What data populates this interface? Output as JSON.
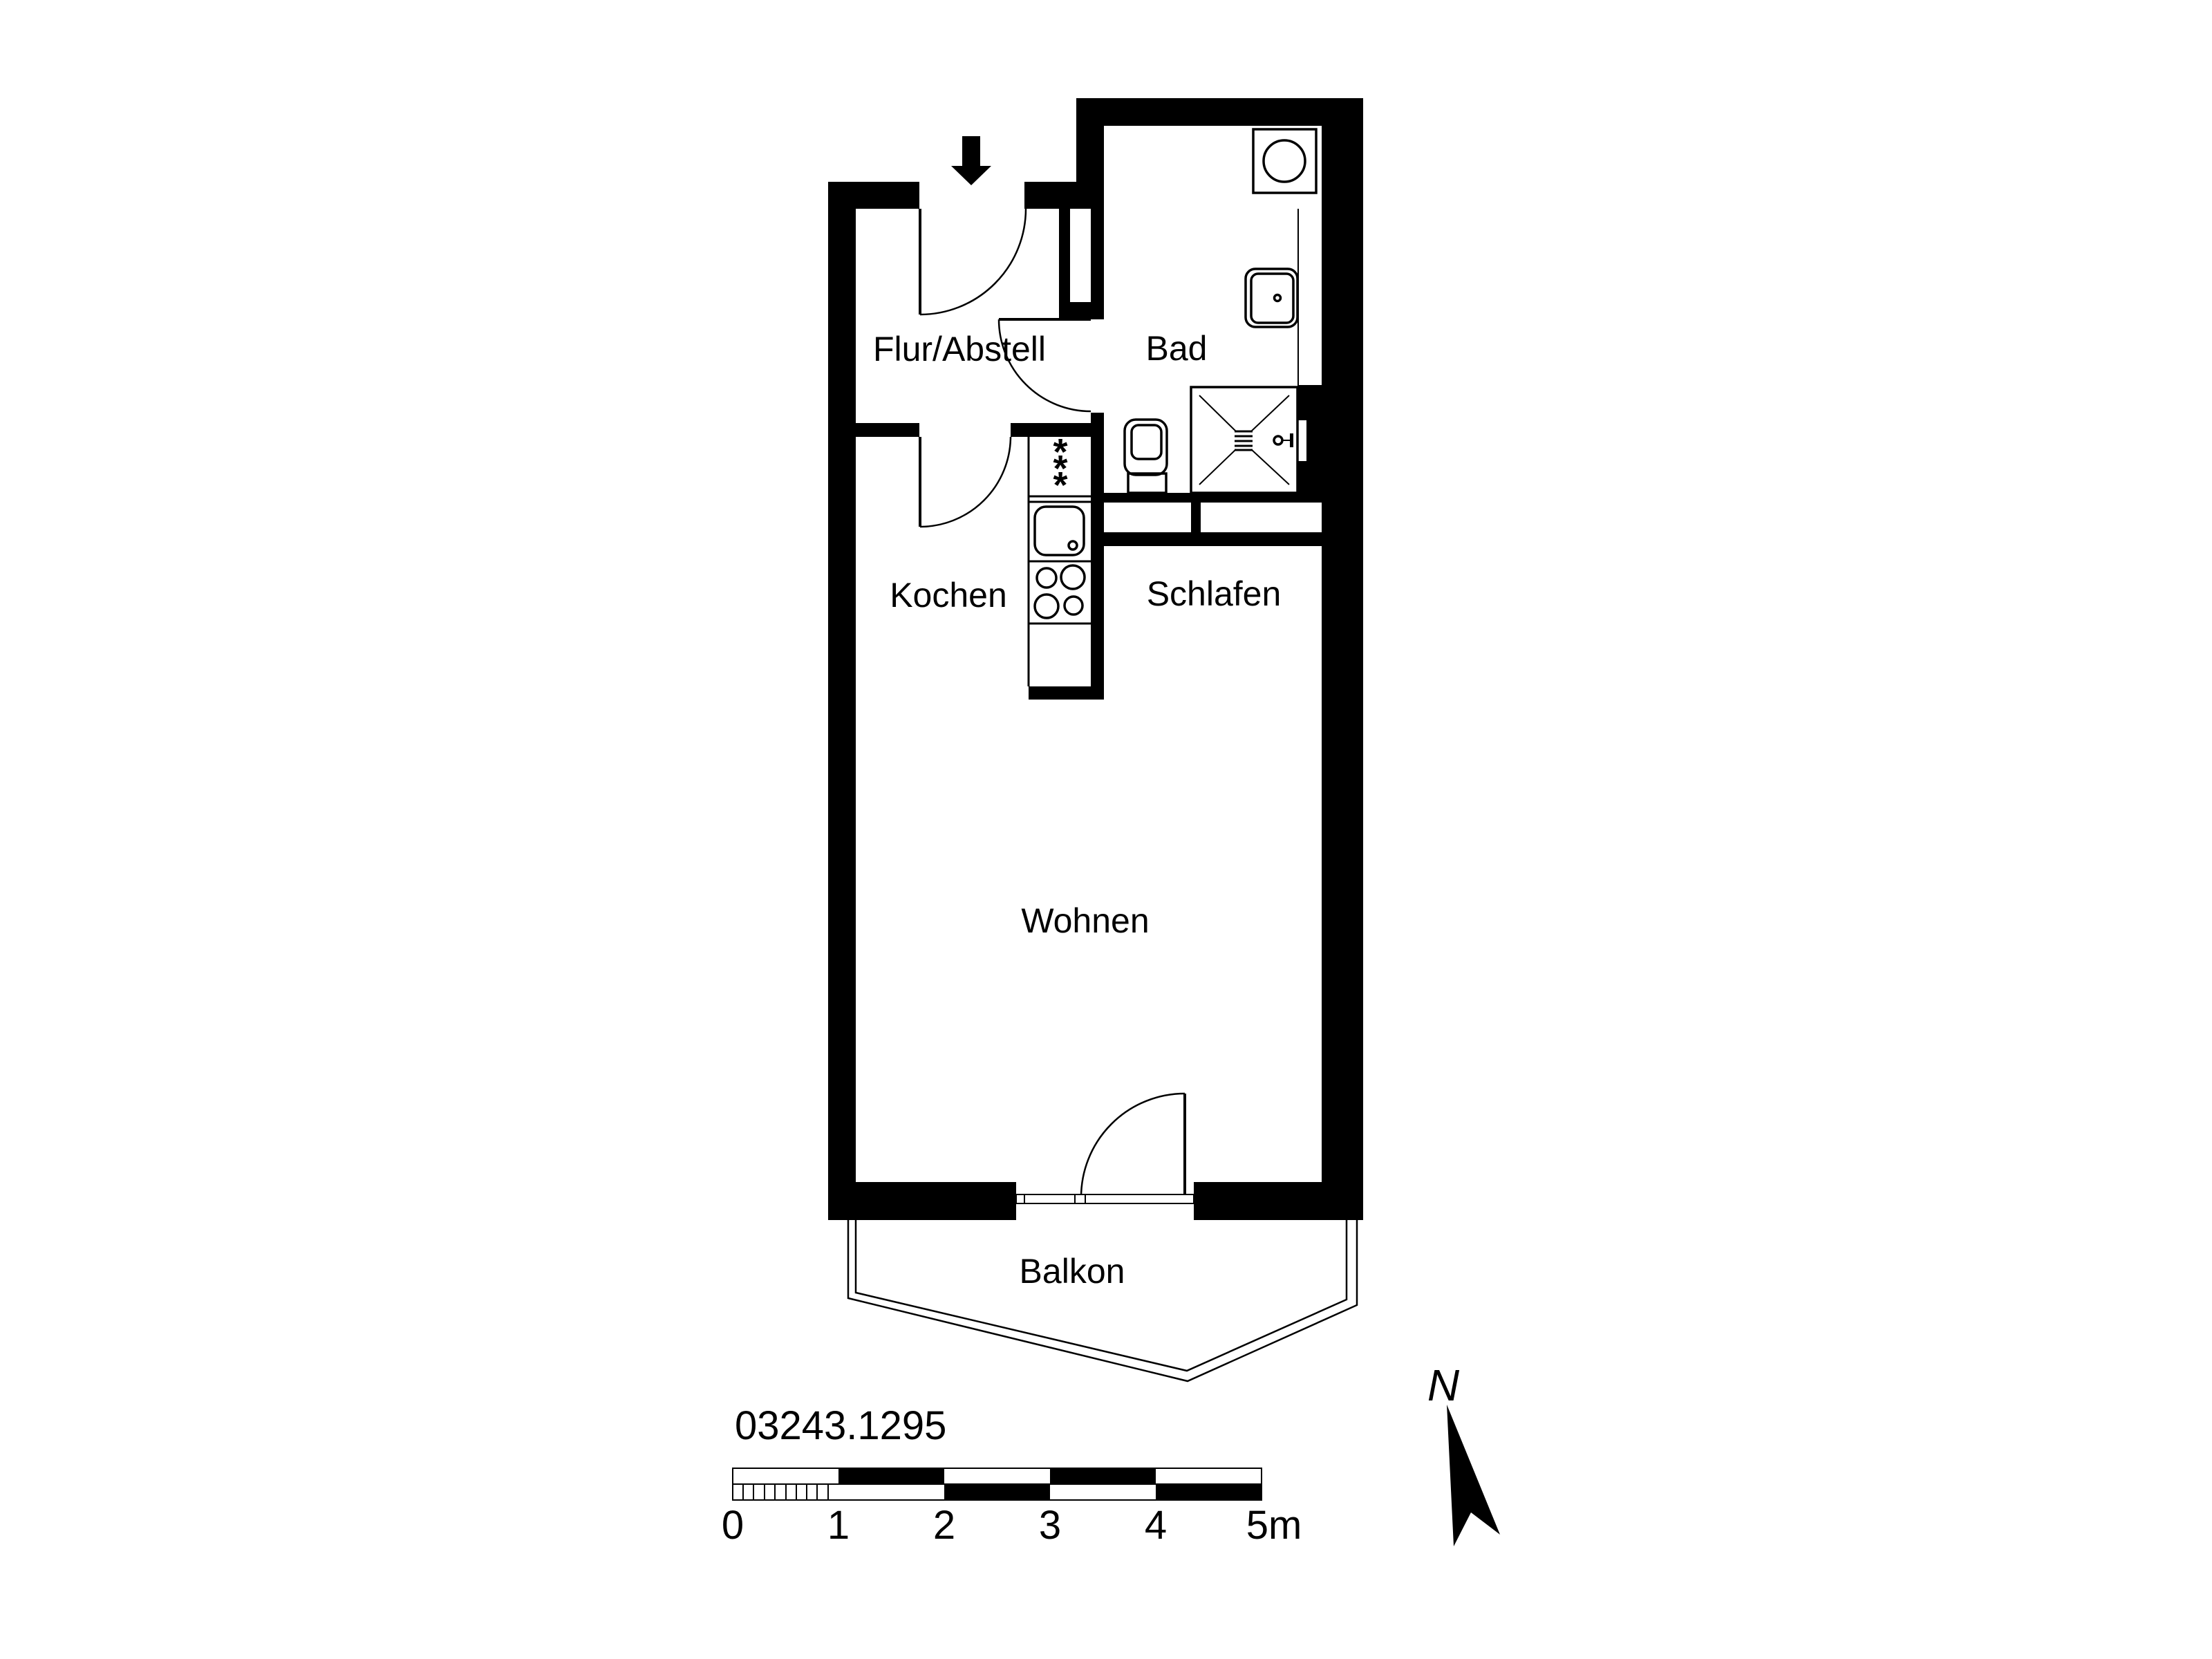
{
  "plan": {
    "number": "03243.1295",
    "rooms": {
      "flur": {
        "label": "Flur/Abstell"
      },
      "bad": {
        "label": "Bad"
      },
      "kochen": {
        "label": "Kochen"
      },
      "schlafen": {
        "label": "Schlafen"
      },
      "wohnen": {
        "label": "Wohnen"
      },
      "balkon": {
        "label": "Balkon"
      }
    },
    "kitchen": {
      "freezer_stars": [
        "*",
        "*",
        "*"
      ]
    },
    "scale_bar": {
      "tick_labels": [
        "0",
        "1",
        "2",
        "3",
        "4",
        "5m"
      ],
      "total_meters": 5,
      "meters_per_segment": 1
    },
    "north_label": "N",
    "icons": [
      "entrance-arrow-icon",
      "washing-machine-icon",
      "bath-sink-icon",
      "toilet-icon",
      "shower-icon",
      "shower-valve-icon",
      "fridge-icon",
      "kitchen-sink-icon",
      "stove-icon",
      "north-arrow-icon"
    ],
    "colors": {
      "ink": "#000000",
      "paper": "#ffffff"
    }
  }
}
